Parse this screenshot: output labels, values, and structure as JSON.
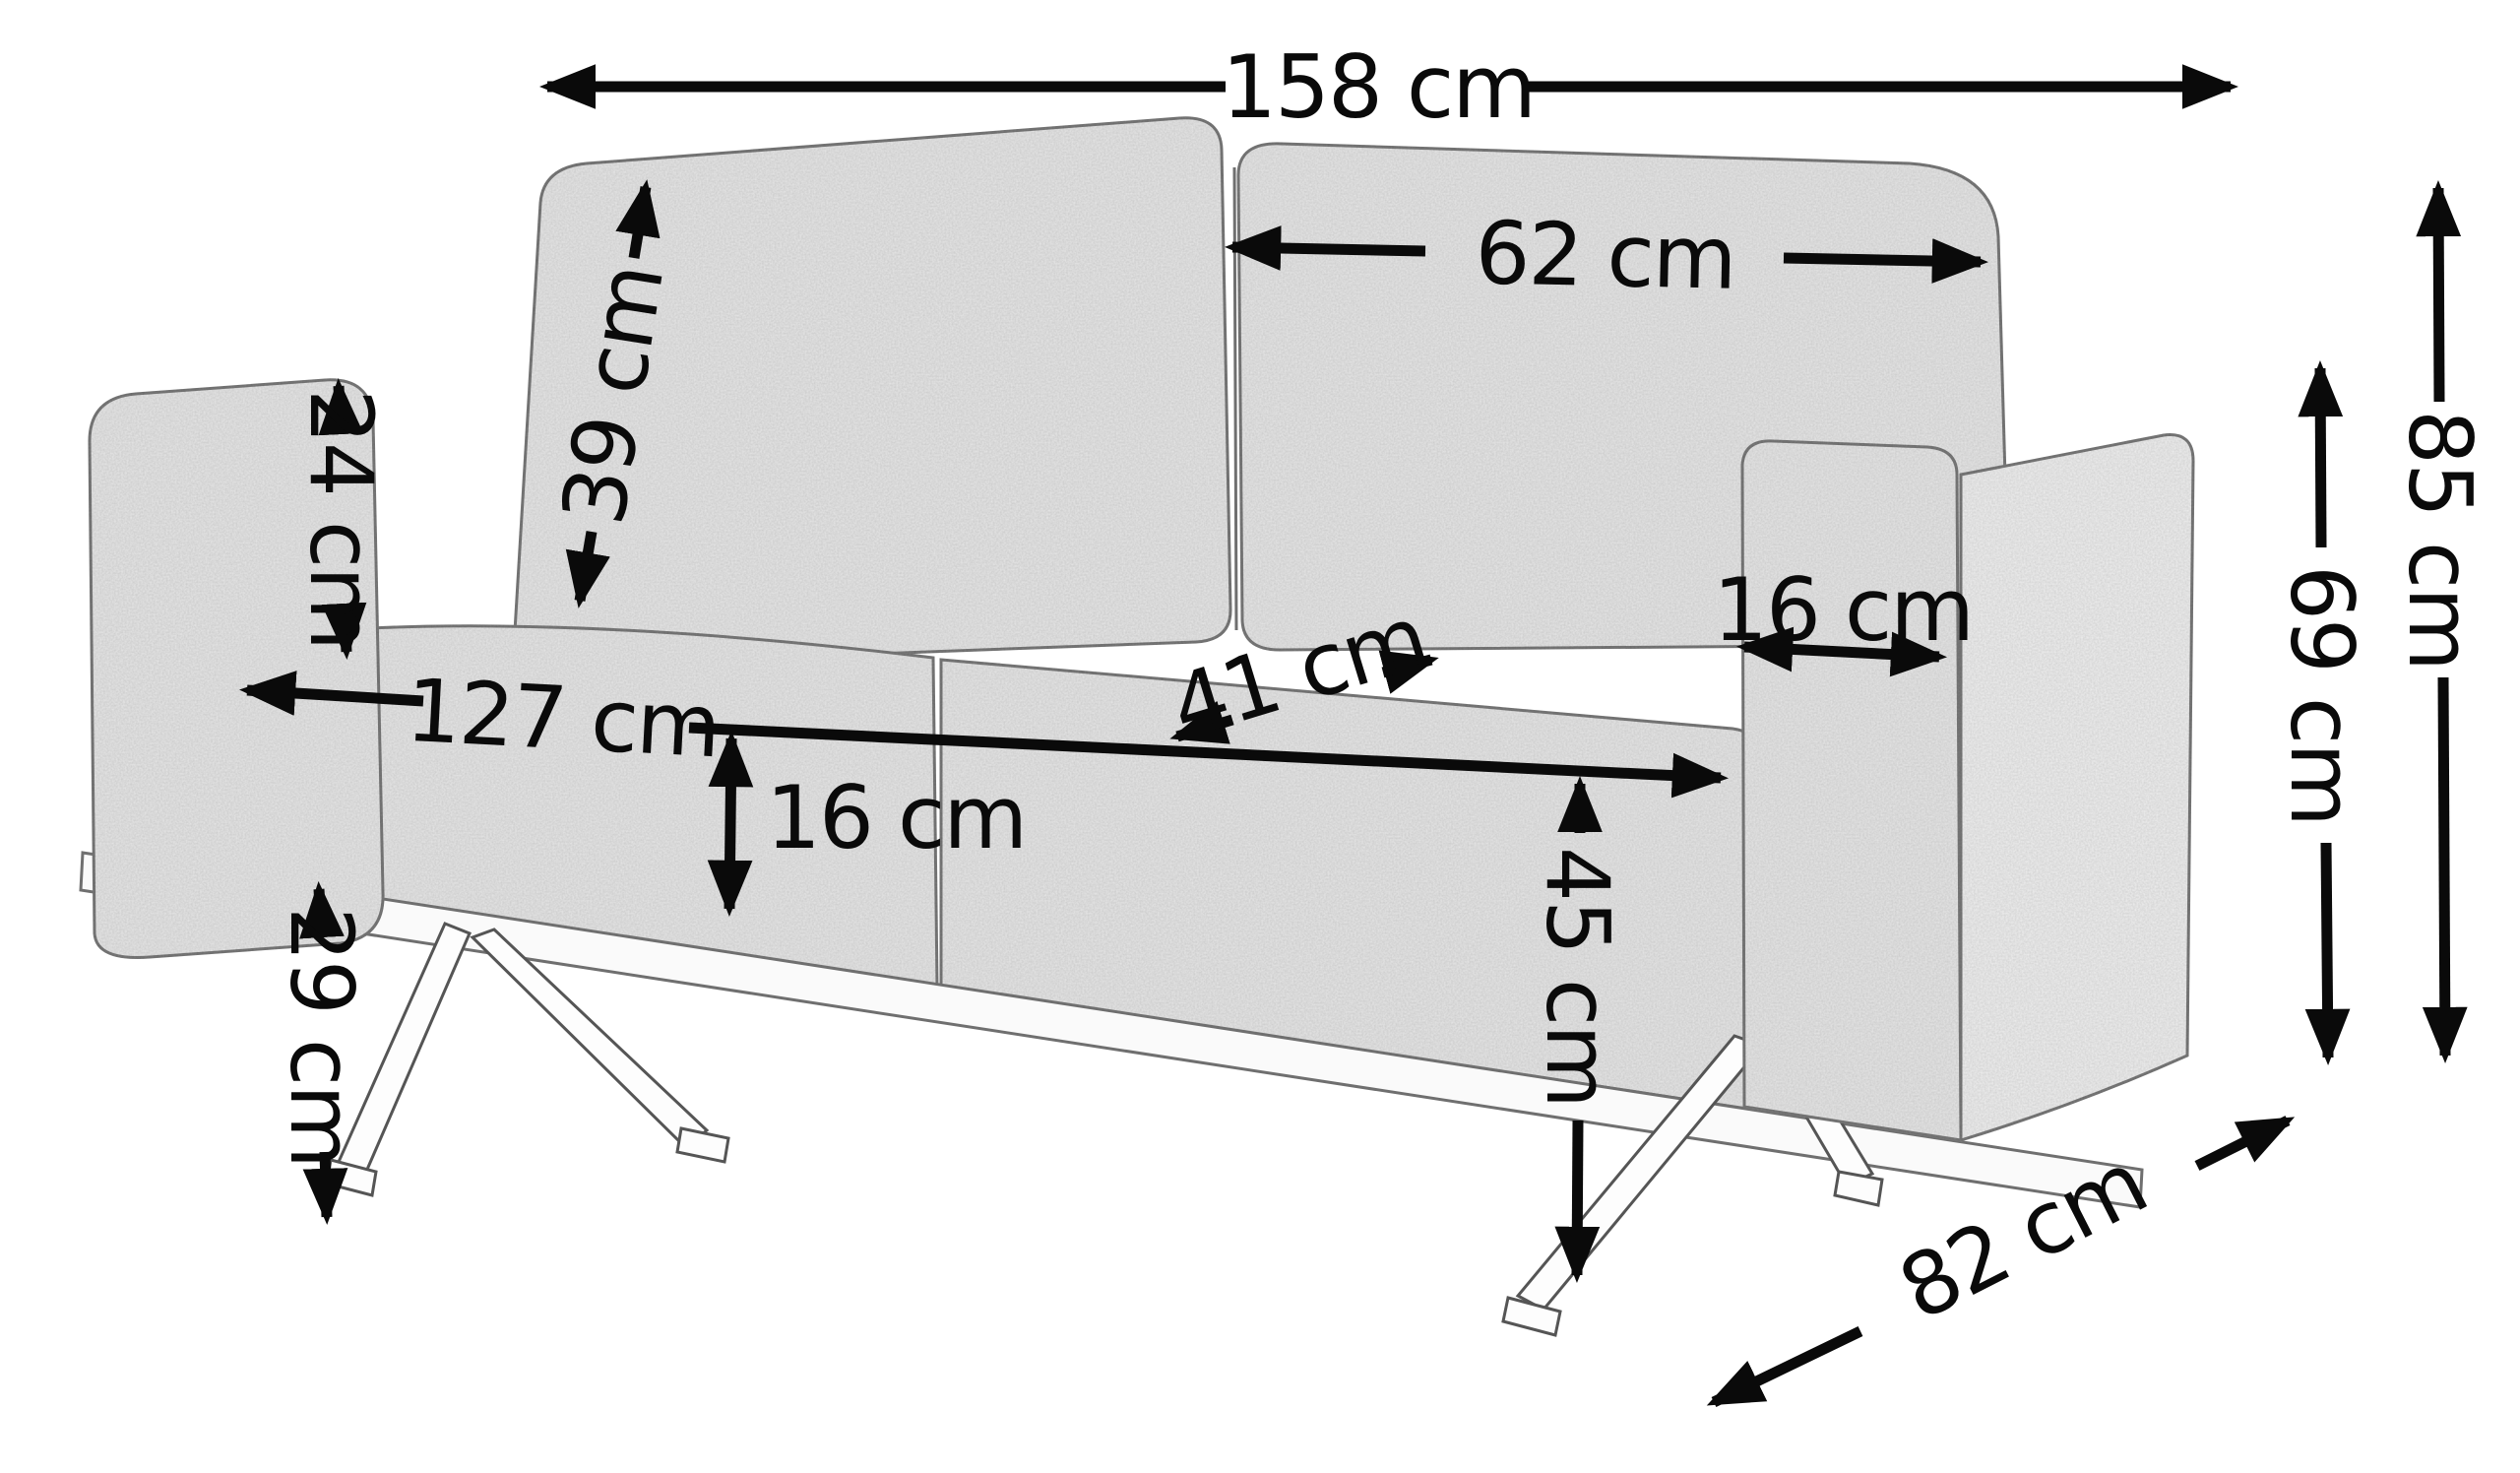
{
  "diagram": {
    "subject": "two-seat-sofa-dimension-diagram",
    "unit": "cm",
    "ink_color": "#0a0a0a",
    "fabric_color": "#e7e7e7",
    "dimensions": {
      "total_width": {
        "label": "158 cm",
        "value": 158
      },
      "back_cushion_width": {
        "label": "62 cm",
        "value": 62
      },
      "back_cushion_height": {
        "label": "39 cm",
        "value": 39
      },
      "armrest_drop": {
        "label": "24 cm",
        "value": 24
      },
      "inner_width": {
        "label": "127 cm",
        "value": 127
      },
      "seat_depth": {
        "label": "41 cm",
        "value": 41
      },
      "armrest_width": {
        "label": "16 cm",
        "value": 16
      },
      "seat_thickness": {
        "label": "16 cm",
        "value": 16
      },
      "floor_clearance": {
        "label": "29 cm",
        "value": 29
      },
      "seat_height": {
        "label": "45 cm",
        "value": 45
      },
      "total_height": {
        "label": "85 cm",
        "value": 85
      },
      "arm_height": {
        "label": "69 cm",
        "value": 69
      },
      "total_depth": {
        "label": "82 cm",
        "value": 82
      }
    }
  }
}
